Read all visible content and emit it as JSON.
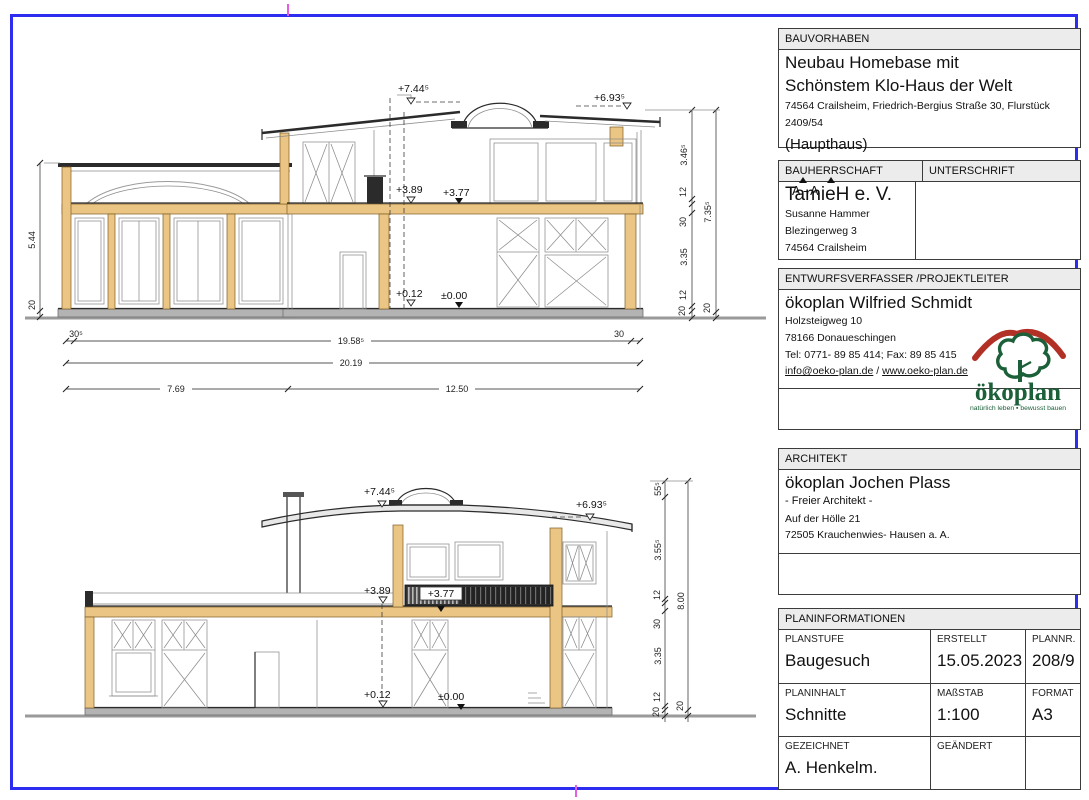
{
  "page": {
    "border_color": "#2d2df2",
    "fold_mark_color": "#e55ce5"
  },
  "drawing": {
    "section_mark": "A - A",
    "top": {
      "levels": {
        "l744": "+7.44⁵",
        "l693": "+6.93⁵",
        "l389": "+3.89",
        "l377": "+3.77",
        "l012": "+0.12",
        "l000": "±0.00"
      },
      "dim_left": [
        "5.44",
        "20"
      ],
      "dim_bottom_row1": [
        "30⁵",
        "19.58⁵",
        "30"
      ],
      "dim_bottom_row2": [
        "20.19"
      ],
      "dim_bottom_row3": [
        "7.69",
        "12.50"
      ],
      "dim_right_inner": [
        "3.46⁵",
        "12",
        "30",
        "3.35",
        "12",
        "20"
      ],
      "dim_right_outer": [
        "7.35⁵",
        "20"
      ]
    },
    "bottom": {
      "levels": {
        "l744": "+7.44⁵",
        "l693": "+6.93⁵",
        "l389": "+3.89",
        "l377": "+3.77",
        "l012": "+0.12",
        "l000": "±0.00"
      },
      "dim_right_inner": [
        "55⁵",
        "3.55⁵",
        "12",
        "30",
        "3.35",
        "12",
        "20"
      ],
      "dim_right_outer": [
        "8.00",
        "20"
      ]
    }
  },
  "titleblock": {
    "bauvorhaben": {
      "header": "BAUVORHABEN",
      "line1": "Neubau Homebase mit",
      "line2": "Schönstem Klo-Haus der Welt",
      "address": "74564 Crailsheim, Friedrich-Bergius Straße 30, Flurstück 2409/54",
      "note": "(Haupthaus)"
    },
    "bauherrschaft": {
      "header": "BAUHERRSCHAFT",
      "header2": "UNTERSCHRIFT",
      "name": "TamieH e. V.",
      "contact": [
        "Susanne Hammer",
        "Blezingerweg 3",
        "74564 Crailsheim"
      ]
    },
    "entwurfsverfasser": {
      "header": "ENTWURFSVERFASSER /PROJEKTLEITER",
      "name": "ökoplan Wilfried Schmidt",
      "lines": [
        "Holzsteigweg 10",
        "78166 Donaueschingen",
        "Tel: 0771- 89 85 414; Fax: 89 85 415"
      ],
      "email": "info@oeko-plan.de",
      "separator": " / ",
      "website": "www.oeko-plan.de",
      "logo": {
        "name": "ökoplan",
        "tagline": "natürlich leben ▪ bewusst bauen"
      }
    },
    "architekt": {
      "header": "ARCHITEKT",
      "name": "ökoplan Jochen Plass",
      "lines": [
        "- Freier Architekt -",
        "Auf der Hölle 21",
        "72505 Krauchenwies- Hausen a. A."
      ]
    },
    "planinformationen": {
      "header": "PLANINFORMATIONEN",
      "cells": [
        {
          "label": "PLANSTUFE",
          "value": "Baugesuch"
        },
        {
          "label": "ERSTELLT",
          "value": "15.05.2023"
        },
        {
          "label": "PLANNR.",
          "value": "208/9"
        },
        {
          "label": "PLANINHALT",
          "value": "Schnitte"
        },
        {
          "label": "MAßSTAB",
          "value": "1:100"
        },
        {
          "label": "FORMAT",
          "value": "A3"
        },
        {
          "label": "GEZEICHNET",
          "value": "A. Henkelm."
        },
        {
          "label": "GEÄNDERT",
          "value": ""
        }
      ]
    }
  }
}
